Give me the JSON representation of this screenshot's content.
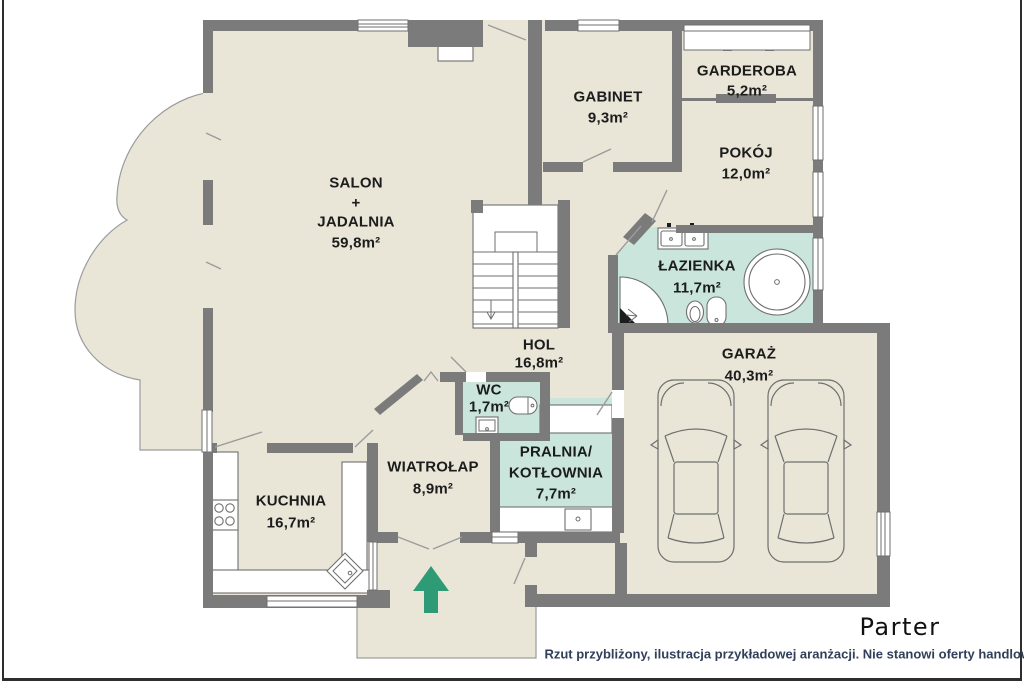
{
  "meta": {
    "floor_title": "Parter",
    "disclaimer": "Rzut przybliżony, ilustracja przykładowej aranżacji. Nie stanowi oferty handlowej."
  },
  "rooms": {
    "salon": {
      "line1": "SALON",
      "line2": "+",
      "line3": "JADALNIA",
      "area": "59,8m²"
    },
    "gabinet": {
      "name": "GABINET",
      "area": "9,3m²"
    },
    "garderoba": {
      "name": "GARDEROBA",
      "area": "5,2m²"
    },
    "pokoj": {
      "name": "POKÓJ",
      "area": "12,0m²"
    },
    "lazienka": {
      "name": "ŁAZIENKA",
      "area": "11,7m²"
    },
    "hol": {
      "name": "HOL",
      "area": "16,8m²"
    },
    "wc": {
      "name": "WC",
      "area": "1,7m²"
    },
    "wiatrolap": {
      "name": "WIATROŁAP",
      "area": "8,9m²"
    },
    "pralnia": {
      "line1": "PRALNIA/",
      "line2": "KOTŁOWNIA",
      "area": "7,7m²"
    },
    "kuchnia": {
      "name": "KUCHNIA",
      "area": "16,7m²"
    },
    "garaz": {
      "name": "GARAŻ",
      "area": "40,3m²"
    }
  },
  "colors": {
    "floor": "#e9e6d8",
    "wet_room": "#c9e5dc",
    "wall": "#7b7b7b",
    "fixture_line": "#6f6f6f",
    "terrace_edge": "#9b9b9b",
    "entrance_arrow": "#2e9b76",
    "label_text": "#1c1c1c",
    "disclaimer_text": "#31405a",
    "frame": "#2e2e2e"
  }
}
